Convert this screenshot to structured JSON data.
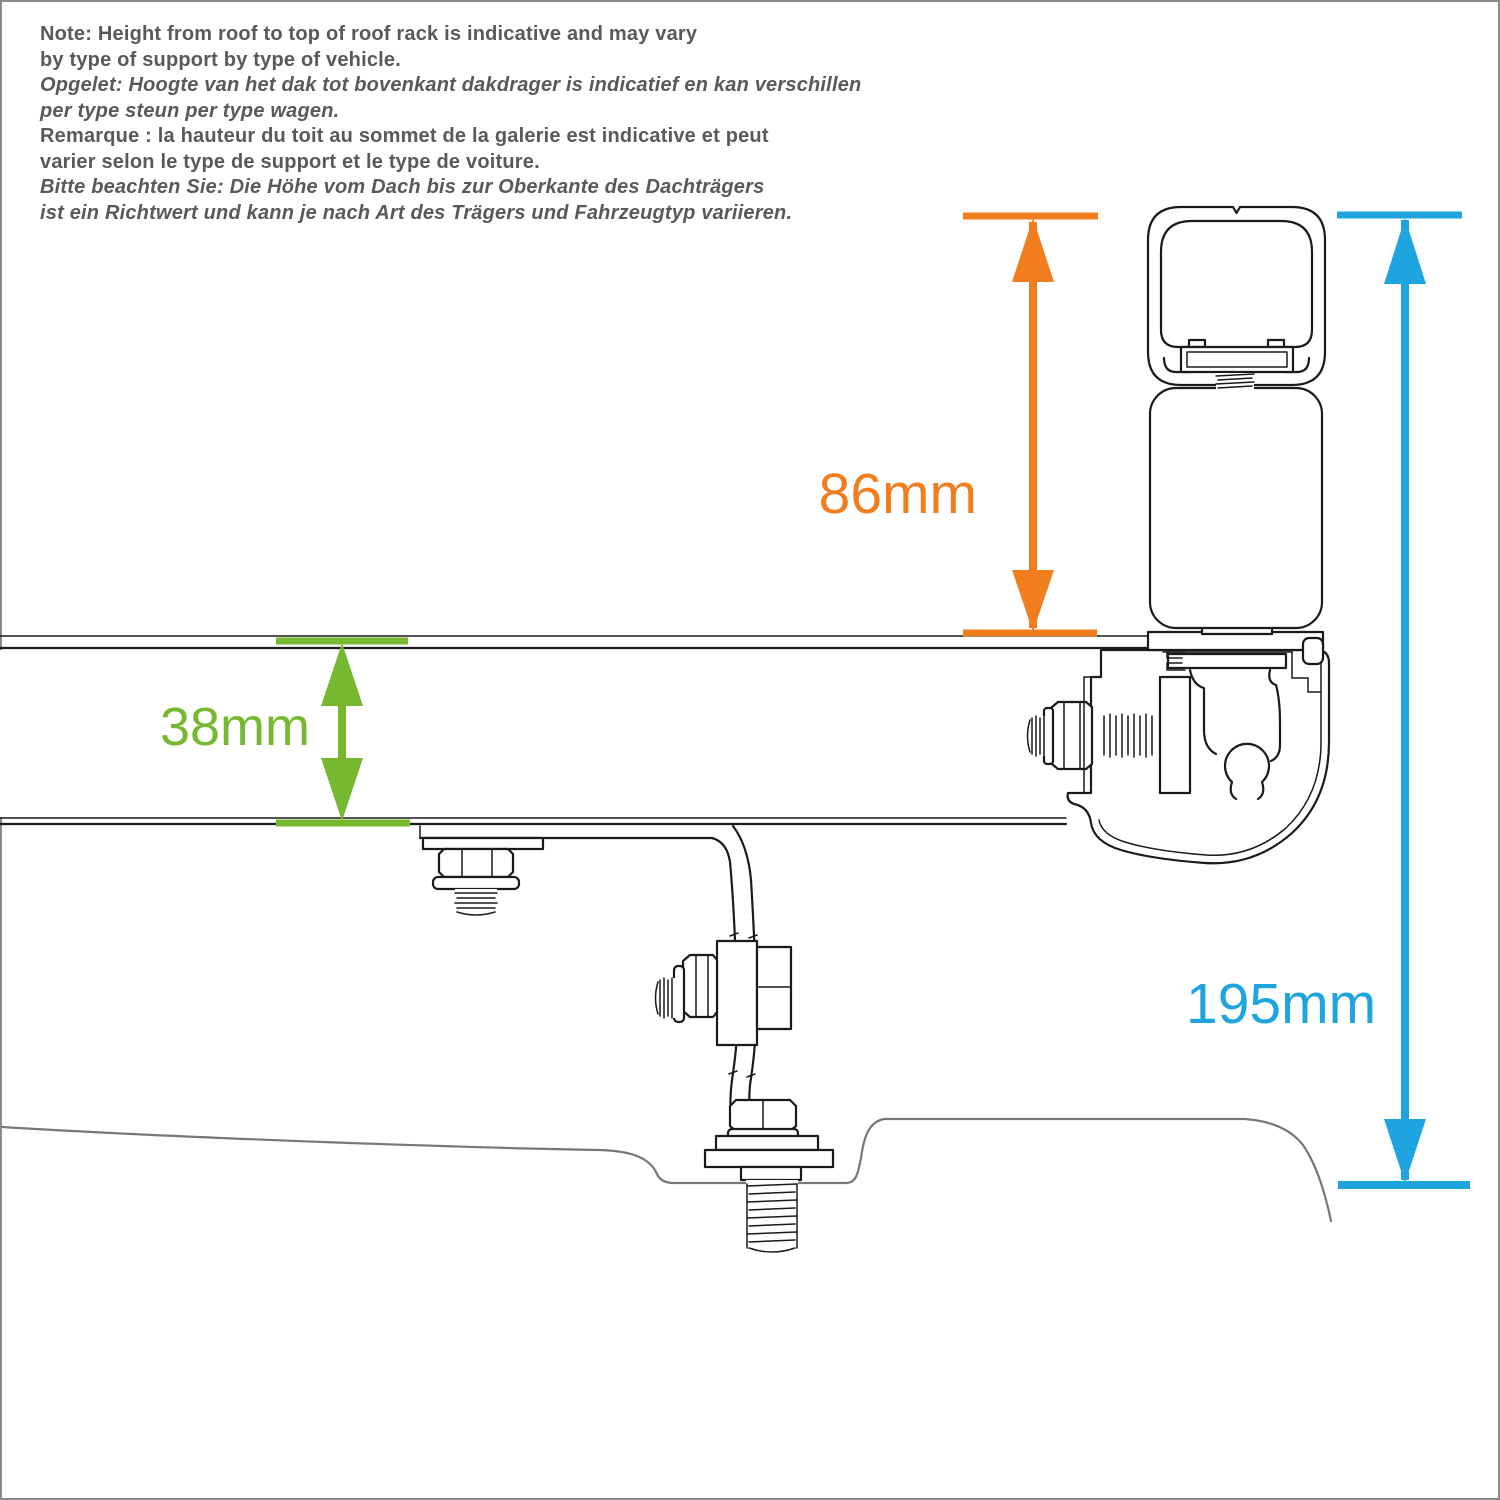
{
  "note": {
    "lines": [
      {
        "text": "Note: Height from roof to top of roof rack is indicative and may vary"
      },
      {
        "text": "by type of support by type of vehicle."
      },
      {
        "text": "Opgelet: Hoogte van het dak tot bovenkant dakdrager is indicatief en kan verschillen"
      },
      {
        "text": "per type steun per type wagen."
      },
      {
        "text": "Remarque : la hauteur du toit au sommet de la galerie est indicative et peut"
      },
      {
        "text": "varier selon le type de support et le type de voiture."
      },
      {
        "text": "Bitte beachten Sie: Die Höhe vom Dach bis zur Oberkante des Dachträgers"
      },
      {
        "text": "ist ein Richtwert und kann je nach Art des Trägers und Fahrzeugtyp variieren."
      }
    ]
  },
  "dimensions": {
    "rack_above_rail": {
      "value": "86mm",
      "color_key": "orange"
    },
    "rail_thickness": {
      "value": "38mm",
      "color_key": "green"
    },
    "roof_to_top": {
      "value": "195mm",
      "color_key": "blue"
    }
  },
  "colors": {
    "orange": "#F07D1E",
    "green": "#76B82F",
    "blue": "#1EA5E0",
    "line": "#1a1a1a",
    "roof_line": "#777777",
    "note_text": "#58595B",
    "border": "#8a8a8a"
  }
}
